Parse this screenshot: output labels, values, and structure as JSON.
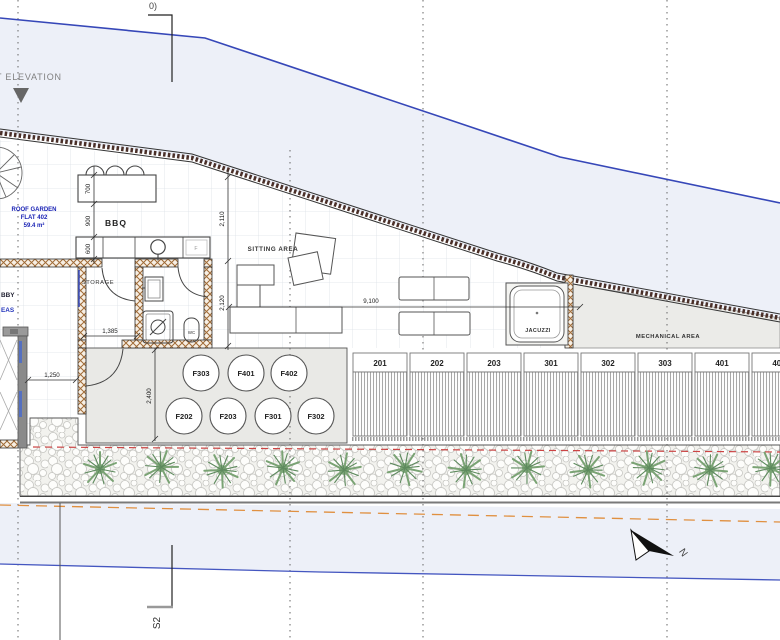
{
  "markers": {
    "section_top_label": "0)",
    "section_bottom_label": "S2",
    "elevation_label": "T ELEVATION",
    "north_label": "N"
  },
  "roof_garden": {
    "name": "ROOF GARDEN",
    "flat": "FLAT 402",
    "area": "59.4 m²"
  },
  "areas": {
    "bbq": "BBQ",
    "sitting": "SITTING AREA",
    "storage": "STORAGE",
    "wc": "WC",
    "fridge": "F",
    "jacuzzi": "JACUZZI",
    "mechanical": "MECHANICAL AREA",
    "lobby_partial": "BBY",
    "eas_partial": "EAS"
  },
  "dimensions": {
    "d700": "700",
    "d900": "900",
    "d600": "600",
    "d2110": "2,110",
    "d2120": "2,120",
    "d1385": "1,385",
    "d1250": "1,250",
    "d2400": "2,400",
    "d9100": "9,100"
  },
  "shafts": [
    "F303",
    "F401",
    "F402",
    "F202",
    "F203",
    "F301",
    "F302"
  ],
  "units": [
    "201",
    "202",
    "203",
    "301",
    "302",
    "303",
    "401",
    "402"
  ],
  "colors": {
    "boundary_blue": "#3647b8",
    "lavender_fill": "#edf0f8",
    "wall_hatch_brown": "#a06a35",
    "parapet_dark": "#4a2f28",
    "deck_gray": "#e9e9e6",
    "mechanical_gray": "#ebebe8",
    "plant_green": "#7aa374",
    "red_dashed": "#cc4444",
    "orange_dashed": "#e09040",
    "blue_text": "#1a23b5",
    "dim_text": "#222222"
  }
}
